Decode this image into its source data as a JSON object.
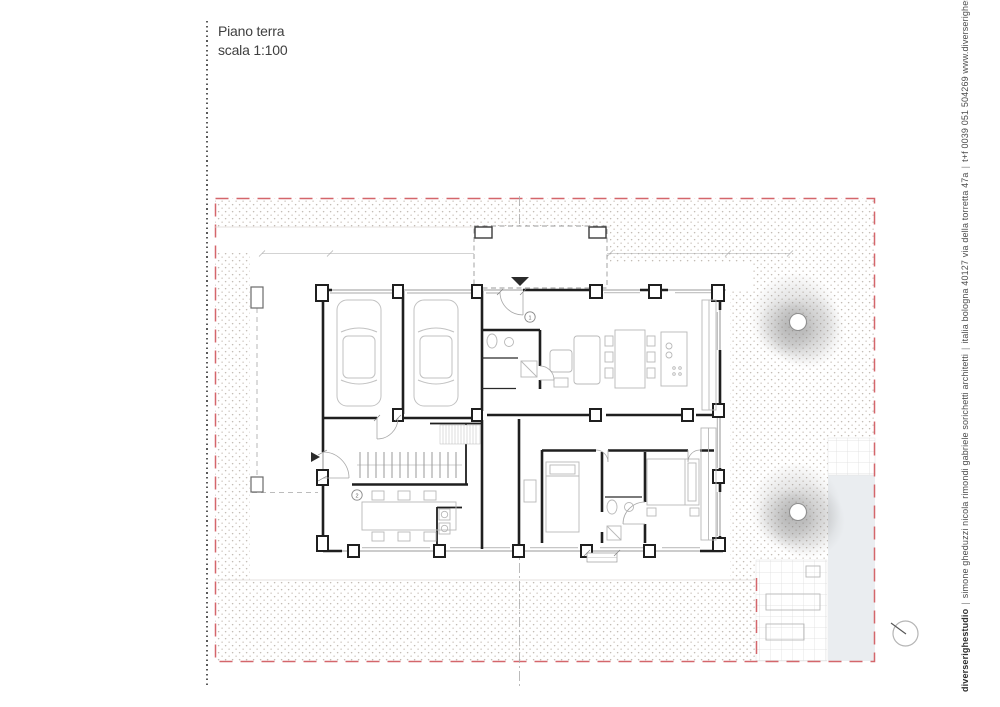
{
  "title_block": {
    "line1": "Piano terra",
    "line2": "scala 1:100"
  },
  "studio_footer": {
    "studio_name": "diverserighestudio",
    "separator": "|",
    "architects": "simone gheduzzi nicola rimondi gabriele sorichetti architetti",
    "address": "italia  bologna 40127  via della torretta 47a",
    "contact": "t+f 0039 051 504269  www.diverserighestudio.it"
  },
  "plan": {
    "drawing_name": "ground-floor-plan",
    "scale": "1:100",
    "room_tags": [
      "1",
      "2"
    ],
    "colors": {
      "boundary_dashed": "#d4666b",
      "hatch_dot": "#c3bbb4",
      "wall": "#1f1f1f",
      "furniture": "#b8b8b8",
      "tile_line": "#dcdcdc",
      "path_strip": "#eaedf0",
      "tree": "#9a9a9a"
    }
  }
}
